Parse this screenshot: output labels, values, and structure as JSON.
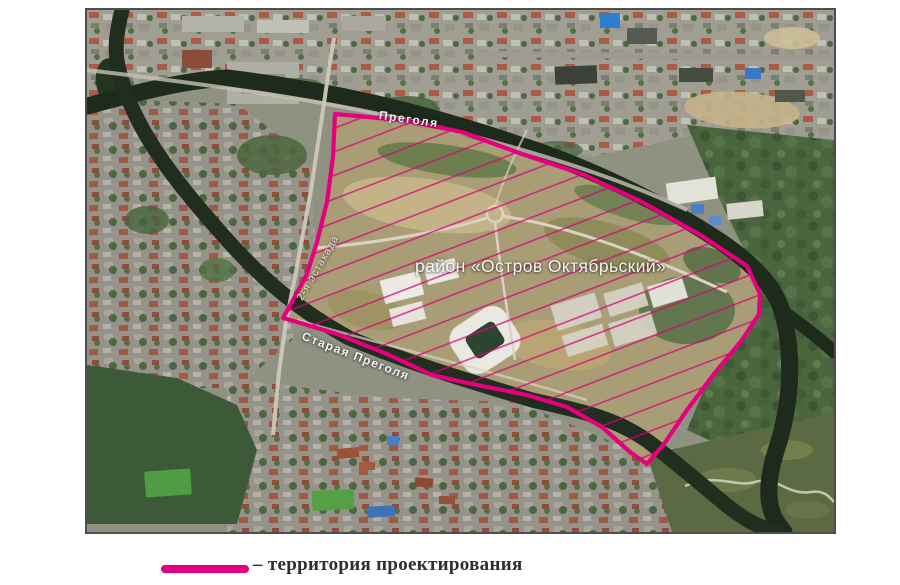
{
  "map": {
    "area_label": "район «Остров Октябрьский»",
    "river_top_label": "Преголя",
    "river_bottom_label": "Старая Преголя",
    "bridge_label": "2-я эстакада"
  },
  "legend": {
    "label": "– территория проектирования",
    "line_color": "#e2007f"
  },
  "colors": {
    "territory_outline": "#e6007d",
    "territory_hatch": "#d4027a"
  }
}
